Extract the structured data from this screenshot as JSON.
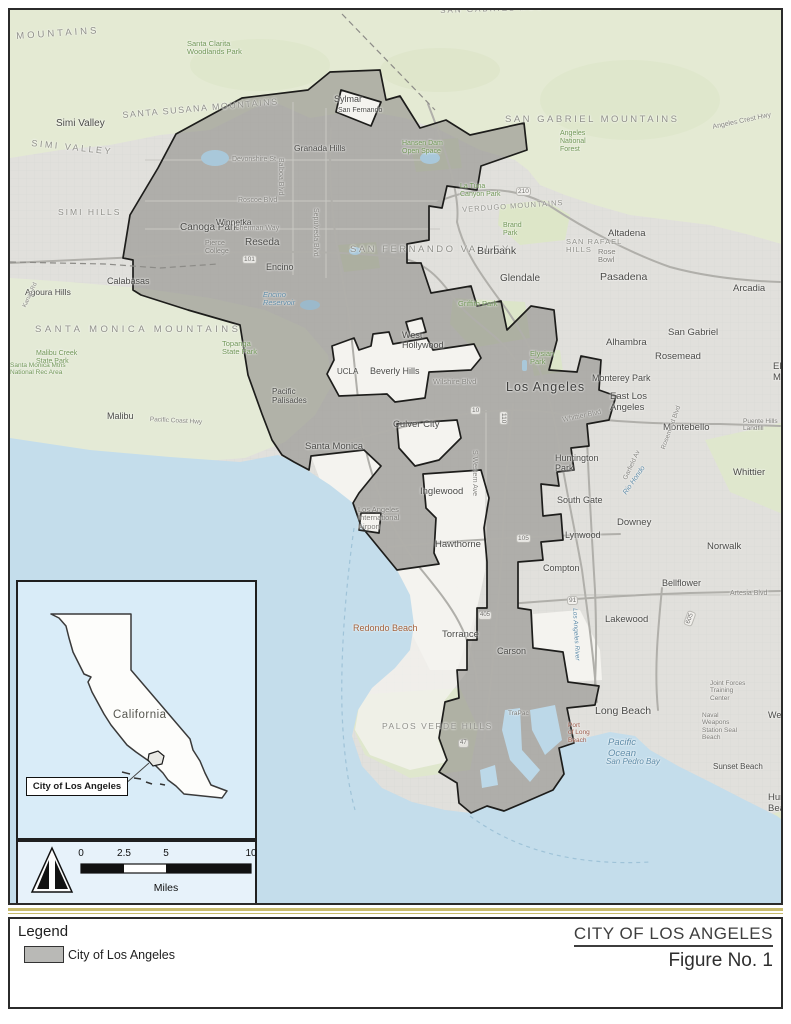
{
  "figure": {
    "title": "CITY OF LOS ANGELES",
    "figure_no": "Figure No. 1"
  },
  "legend": {
    "title": "Legend",
    "items": [
      {
        "label": "City of Los Angeles",
        "swatch_color": "#b9b9b6"
      }
    ]
  },
  "inset": {
    "state_label": "California",
    "callout_label": "City of Los Angeles"
  },
  "scale_bar": {
    "ticks": [
      "0",
      "2.5",
      "5",
      "10"
    ],
    "tick_x": [
      63,
      106,
      148,
      233
    ],
    "unit": "Miles"
  },
  "colors": {
    "city_fill": "#a9a8a4",
    "enclave": "#f4f3ef",
    "ocean": "#c4ddeb",
    "mountains": "#e4ead3",
    "separator": "#c9bc6e",
    "inset_bg": "#d9ecf8"
  },
  "map": {
    "labels": [
      {
        "t": "MOUNTAINS",
        "x": 6,
        "y": 22,
        "c": "region",
        "r": -4,
        "ls": 3
      },
      {
        "t": "SAN GABRIEL MOUNTAINS",
        "x": 430,
        "y": -3,
        "c": "region",
        "s": 8,
        "r": -2
      },
      {
        "t": "SANTA SUSANA MOUNTAINS",
        "x": 112,
        "y": 100,
        "c": "region",
        "s": 9,
        "ls": 1.5,
        "r": -5
      },
      {
        "t": "SIMI VALLEY",
        "x": 22,
        "y": 128,
        "c": "region",
        "s": 9,
        "ls": 2.5,
        "r": 6
      },
      {
        "t": "SIMI HILLS",
        "x": 48,
        "y": 198,
        "c": "region",
        "s": 8.5,
        "ls": 2
      },
      {
        "t": "SAN GABRIEL MOUNTAINS",
        "x": 495,
        "y": 105,
        "c": "region",
        "s": 9.5,
        "ls": 2.5
      },
      {
        "t": "SAN FERNANDO VALLEY",
        "x": 340,
        "y": 235,
        "c": "region",
        "s": 9.5,
        "ls": 2.5
      },
      {
        "t": "VERDUGO MOUNTAINS",
        "x": 452,
        "y": 196,
        "c": "region",
        "s": 7.5,
        "ls": 1,
        "r": -4
      },
      {
        "t": "SAN RAFAEL\nHILLS",
        "x": 556,
        "y": 228,
        "c": "region",
        "s": 7.5,
        "ls": 1
      },
      {
        "t": "SANTA MONICA MOUNTAINS",
        "x": 25,
        "y": 315,
        "c": "region",
        "s": 9.5,
        "ls": 3.5
      },
      {
        "t": "PALOS VERDE HILLS",
        "x": 372,
        "y": 712,
        "c": "region",
        "s": 8.5,
        "ls": 1.5
      },
      {
        "t": "Simi Valley",
        "x": 46,
        "y": 108,
        "c": "city"
      },
      {
        "t": "Sylmar",
        "x": 324,
        "y": 84,
        "c": "city",
        "s": 9
      },
      {
        "t": "San Fernando",
        "x": 328,
        "y": 97,
        "c": "city",
        "s": 7
      },
      {
        "t": "Granada Hills",
        "x": 284,
        "y": 134,
        "c": "city",
        "s": 8.5
      },
      {
        "t": "Canoga Park",
        "x": 170,
        "y": 212,
        "c": "city"
      },
      {
        "t": "Winnetka",
        "x": 206,
        "y": 208,
        "c": "city",
        "s": 8.5
      },
      {
        "t": "Reseda",
        "x": 235,
        "y": 227,
        "c": "city"
      },
      {
        "t": "Encino",
        "x": 256,
        "y": 252,
        "c": "city",
        "s": 9
      },
      {
        "t": "Calabasas",
        "x": 97,
        "y": 266,
        "c": "city",
        "s": 9
      },
      {
        "t": "Agoura Hills",
        "x": 15,
        "y": 278,
        "c": "city",
        "s": 8.5
      },
      {
        "t": "Malibu",
        "x": 97,
        "y": 401,
        "c": "city",
        "s": 9
      },
      {
        "t": "Pacific\nPalisades",
        "x": 262,
        "y": 378,
        "c": "city",
        "s": 8
      },
      {
        "t": "Burbank",
        "x": 467,
        "y": 236,
        "c": "city",
        "s": 10.5
      },
      {
        "t": "Glendale",
        "x": 490,
        "y": 263,
        "c": "city",
        "s": 10
      },
      {
        "t": "Altadena",
        "x": 598,
        "y": 219,
        "c": "city",
        "s": 9.5
      },
      {
        "t": "Pasadena",
        "x": 590,
        "y": 262,
        "c": "city",
        "s": 10.5
      },
      {
        "t": "Arcadia",
        "x": 723,
        "y": 274,
        "c": "city",
        "s": 9.5
      },
      {
        "t": "San Gabriel",
        "x": 658,
        "y": 318,
        "c": "city",
        "s": 9.5
      },
      {
        "t": "Alhambra",
        "x": 596,
        "y": 328,
        "c": "city",
        "s": 9.5
      },
      {
        "t": "Rosemead",
        "x": 645,
        "y": 342,
        "c": "city",
        "s": 9.5
      },
      {
        "t": "El Monte",
        "x": 763,
        "y": 352,
        "c": "city",
        "s": 9.5
      },
      {
        "t": "Monterey Park",
        "x": 582,
        "y": 363,
        "c": "city",
        "s": 9
      },
      {
        "t": "East Los\nAngeles",
        "x": 600,
        "y": 382,
        "c": "city",
        "s": 9.5
      },
      {
        "t": "Montebello",
        "x": 653,
        "y": 413,
        "c": "city",
        "s": 9.5
      },
      {
        "t": "Whittier",
        "x": 723,
        "y": 458,
        "c": "city",
        "s": 9.5
      },
      {
        "t": "Los Angeles",
        "x": 496,
        "y": 370,
        "c": "city-lg"
      },
      {
        "t": "Huntington\nPark",
        "x": 545,
        "y": 443,
        "c": "city",
        "s": 9
      },
      {
        "t": "South Gate",
        "x": 547,
        "y": 485,
        "c": "city",
        "s": 9
      },
      {
        "t": "Lynwood",
        "x": 555,
        "y": 520,
        "c": "city",
        "s": 9
      },
      {
        "t": "Downey",
        "x": 607,
        "y": 508,
        "c": "city",
        "s": 9.5
      },
      {
        "t": "Norwalk",
        "x": 697,
        "y": 532,
        "c": "city",
        "s": 9.5
      },
      {
        "t": "Compton",
        "x": 533,
        "y": 553,
        "c": "city",
        "s": 9
      },
      {
        "t": "Bellflower",
        "x": 652,
        "y": 568,
        "c": "city",
        "s": 9
      },
      {
        "t": "Lakewood",
        "x": 595,
        "y": 605,
        "c": "city",
        "s": 9.5
      },
      {
        "t": "Hawthorne",
        "x": 425,
        "y": 530,
        "c": "city",
        "s": 9.5
      },
      {
        "t": "Inglewood",
        "x": 410,
        "y": 477,
        "c": "city",
        "s": 9.5
      },
      {
        "t": "Santa Monica",
        "x": 295,
        "y": 432,
        "c": "city",
        "s": 9.5
      },
      {
        "t": "Culver City",
        "x": 383,
        "y": 410,
        "c": "city",
        "s": 9.5
      },
      {
        "t": "West\nHollywood",
        "x": 392,
        "y": 320,
        "c": "city",
        "s": 9
      },
      {
        "t": "Beverly Hills",
        "x": 360,
        "y": 356,
        "c": "city",
        "s": 9
      },
      {
        "t": "UCLA",
        "x": 327,
        "y": 358,
        "c": "city",
        "s": 8
      },
      {
        "t": "Redondo Beach",
        "x": 343,
        "y": 613,
        "c": "city-orange"
      },
      {
        "t": "Torrance",
        "x": 432,
        "y": 620,
        "c": "city",
        "s": 9.5
      },
      {
        "t": "Carson",
        "x": 487,
        "y": 636,
        "c": "city",
        "s": 9
      },
      {
        "t": "Long Beach",
        "x": 585,
        "y": 696,
        "c": "city",
        "s": 10.5
      },
      {
        "t": "Sunset Beach",
        "x": 703,
        "y": 753,
        "c": "city",
        "s": 8
      },
      {
        "t": "Westminster",
        "x": 758,
        "y": 700,
        "c": "city",
        "s": 9
      },
      {
        "t": "Huntington Beach",
        "x": 758,
        "y": 783,
        "c": "city",
        "s": 9.5
      },
      {
        "t": "Santa Clarita\nWoodlands Park",
        "x": 177,
        "y": 30,
        "c": "park"
      },
      {
        "t": "Hansen Dam\nOpen Space",
        "x": 392,
        "y": 130,
        "c": "park",
        "s": 7
      },
      {
        "t": "La Tuna\nCanyon Park",
        "x": 450,
        "y": 173,
        "c": "park",
        "s": 7
      },
      {
        "t": "Brand\nPark",
        "x": 493,
        "y": 212,
        "c": "park",
        "s": 7
      },
      {
        "t": "Angeles\nNational\nForest",
        "x": 550,
        "y": 120,
        "c": "park",
        "s": 7
      },
      {
        "t": "Griffith Park",
        "x": 448,
        "y": 290,
        "c": "park"
      },
      {
        "t": "Elysian\nPark",
        "x": 520,
        "y": 340,
        "c": "park"
      },
      {
        "t": "Topanga\nState Park",
        "x": 212,
        "y": 330,
        "c": "park"
      },
      {
        "t": "Malibu Creek\nState Park",
        "x": 26,
        "y": 340,
        "c": "park",
        "s": 7
      },
      {
        "t": "Santa Monica Mtns\nNational Rec Area",
        "x": 0,
        "y": 352,
        "c": "park",
        "s": 6.5
      },
      {
        "t": "Pierce\nCollege",
        "x": 195,
        "y": 230,
        "c": "poi",
        "s": 7
      },
      {
        "t": "Rose\nBowl",
        "x": 588,
        "y": 238,
        "c": "poi"
      },
      {
        "t": "Los Angeles\nInternational\nAirport",
        "x": 348,
        "y": 496,
        "c": "poi"
      },
      {
        "t": "Joint Forces\nTraining\nCenter",
        "x": 700,
        "y": 670,
        "c": "poi",
        "s": 6.5
      },
      {
        "t": "Naval\nWeapons\nStation Seal\nBeach",
        "x": 692,
        "y": 702,
        "c": "poi",
        "s": 6.5
      },
      {
        "t": "Port\nof Long\nBeach",
        "x": 558,
        "y": 712,
        "c": "poi-red",
        "s": 6.5
      },
      {
        "t": "TraPac",
        "x": 498,
        "y": 700,
        "c": "poi",
        "s": 6.5
      },
      {
        "t": "Puente Hills\nLandfill",
        "x": 733,
        "y": 408,
        "c": "poi",
        "s": 6.5
      },
      {
        "t": "Encino\nReservoir",
        "x": 253,
        "y": 281,
        "c": "water"
      },
      {
        "t": "Pacific\nOcean",
        "x": 598,
        "y": 728,
        "c": "water",
        "s": 9.5
      },
      {
        "t": "San Pedro Bay",
        "x": 596,
        "y": 748,
        "c": "water",
        "s": 8
      },
      {
        "t": "Los Angeles River",
        "x": 568,
        "y": 598,
        "c": "water",
        "s": 6.5,
        "r": 87
      },
      {
        "t": "Rio Hondo",
        "x": 612,
        "y": 482,
        "c": "water",
        "s": 7,
        "r": -55
      },
      {
        "t": "Devonshire St",
        "x": 222,
        "y": 146,
        "c": "street"
      },
      {
        "t": "Roscoe Blvd",
        "x": 228,
        "y": 187,
        "c": "street"
      },
      {
        "t": "Sherman Way",
        "x": 225,
        "y": 215,
        "c": "street"
      },
      {
        "t": "Balboa Blvd",
        "x": 274,
        "y": 148,
        "c": "street",
        "r": 90
      },
      {
        "t": "Sepulveda Blvd",
        "x": 309,
        "y": 198,
        "c": "street",
        "r": 90
      },
      {
        "t": "Wilshire Blvd",
        "x": 423,
        "y": 368,
        "c": "street",
        "s": 7.5
      },
      {
        "t": "S Western Ave",
        "x": 468,
        "y": 440,
        "c": "street",
        "r": 90
      },
      {
        "t": "Whittier Blvd",
        "x": 552,
        "y": 407,
        "c": "street",
        "r": -12
      },
      {
        "t": "Artesia Blvd",
        "x": 720,
        "y": 580,
        "c": "street"
      },
      {
        "t": "Angeles Crest Hwy",
        "x": 702,
        "y": 114,
        "c": "street",
        "r": -12
      },
      {
        "t": "Pacific Coast Hwy",
        "x": 140,
        "y": 406,
        "c": "street",
        "s": 6.5,
        "r": 3
      },
      {
        "t": "Garfield Av",
        "x": 612,
        "y": 468,
        "c": "street",
        "s": 6.5,
        "r": -65
      },
      {
        "t": "Rosemead Blvd",
        "x": 650,
        "y": 438,
        "c": "street",
        "s": 6.5,
        "r": -70
      },
      {
        "t": "Kanan Rd",
        "x": 12,
        "y": 296,
        "c": "street",
        "s": 6,
        "r": -65
      },
      {
        "t": "101",
        "x": 232,
        "y": 245,
        "c": "hwy"
      },
      {
        "t": "210",
        "x": 506,
        "y": 177,
        "c": "hwy"
      },
      {
        "t": "110",
        "x": 498,
        "y": 401,
        "c": "hwy",
        "r": 90
      },
      {
        "t": "10",
        "x": 460,
        "y": 396,
        "c": "hwy"
      },
      {
        "t": "105",
        "x": 506,
        "y": 524,
        "c": "hwy"
      },
      {
        "t": "605",
        "x": 673,
        "y": 614,
        "c": "hwy",
        "r": -70
      },
      {
        "t": "91",
        "x": 557,
        "y": 586,
        "c": "hwy"
      },
      {
        "t": "405",
        "x": 468,
        "y": 601,
        "c": "hwy",
        "s": 6
      },
      {
        "t": "47",
        "x": 448,
        "y": 729,
        "c": "hwy",
        "s": 6
      }
    ]
  }
}
